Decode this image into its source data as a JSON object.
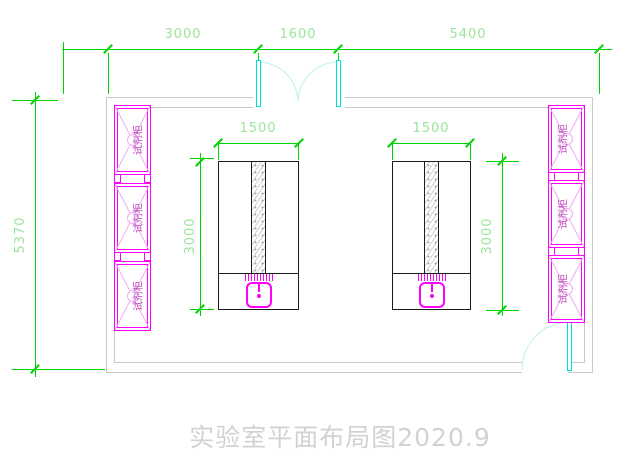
{
  "drawing_title": "实验室平面布局图2020.9",
  "colors": {
    "dim-line": "#00d400",
    "dim-text": "#9ae49a",
    "wall-gray": "#c9c9c9",
    "bench-line": "#1c1c1c",
    "hatch-gray": "#cfcfcf",
    "cabinet-magenta": "#ff00ff",
    "cabinet-pink": "#f2aaf2",
    "cabinet-text": "#bb44bb",
    "door-cyan": "#00e0e0",
    "door-arc": "#bdf0ec",
    "sink-magenta": "#ff00ff",
    "title-gray": "#d2d2d2"
  },
  "dimensions": {
    "top": {
      "seg1": "3000",
      "seg2": "1600",
      "seg3": "5400"
    },
    "room_height": "5370",
    "bench_left": {
      "width": "1500",
      "length": "3000"
    },
    "bench_right": {
      "width": "1500",
      "length": "3000"
    }
  },
  "cabinets": {
    "left": [
      {
        "label": "试剂柜"
      },
      {
        "label": "试剂柜"
      },
      {
        "label": "试剂柜"
      }
    ],
    "right": [
      {
        "label": "试剂柜"
      },
      {
        "label": "试剂柜"
      },
      {
        "label": "试剂柜"
      }
    ]
  }
}
